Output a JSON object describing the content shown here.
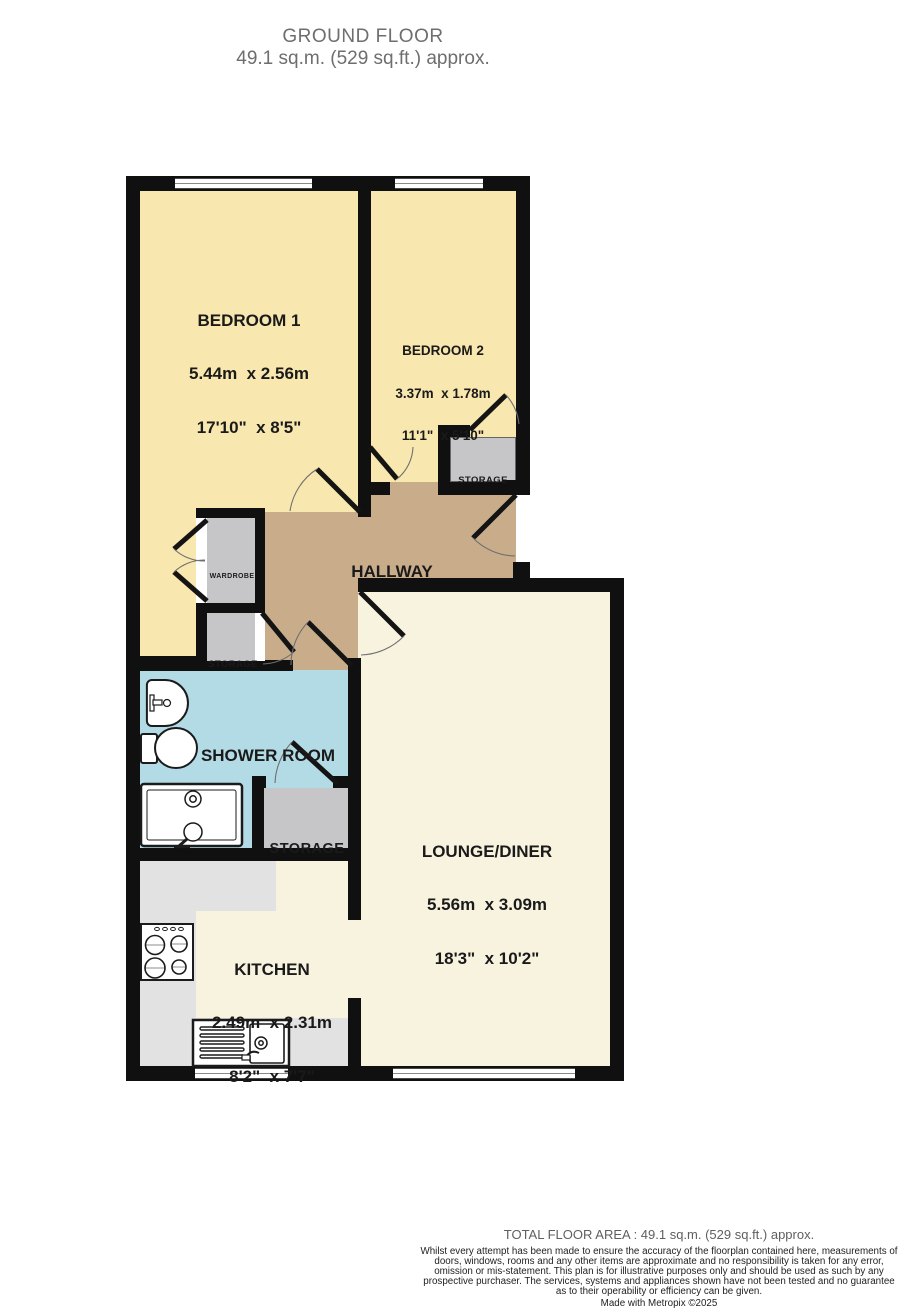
{
  "title": {
    "line1": "GROUND FLOOR",
    "line2": "49.1 sq.m. (529 sq.ft.) approx."
  },
  "rooms": {
    "bedroom1": {
      "name": "BEDROOM 1",
      "metric": "5.44m  x 2.56m",
      "imperial": "17'10\"  x 8'5\""
    },
    "bedroom2": {
      "name": "BEDROOM 2",
      "metric": "3.37m  x 1.78m",
      "imperial": "11'1\"  x 5'10\""
    },
    "hallway": {
      "name": "HALLWAY"
    },
    "shower_room": {
      "name": "SHOWER ROOM"
    },
    "lounge_diner": {
      "name": "LOUNGE/DINER",
      "metric": "5.56m  x 3.09m",
      "imperial": "18'3\"  x 10'2\""
    },
    "kitchen": {
      "name": "KITCHEN",
      "metric": "2.49m  x 2.31m",
      "imperial": "8'2\"  x 7'7\""
    },
    "storage_bedroom2": {
      "name": "STORAGE"
    },
    "storage_hall": {
      "name": "STORAGE"
    },
    "storage_shower": {
      "name": "STORAGE"
    },
    "wardrobe": {
      "name": "WARDROBE"
    }
  },
  "footer": {
    "total_area": "TOTAL FLOOR AREA : 49.1 sq.m. (529 sq.ft.) approx.",
    "disclaimer": "Whilst every attempt has been made to ensure the accuracy of the floorplan contained here, measurements of doors, windows, rooms and any other items are approximate and no responsibility is taken for any error, omission or mis-statement. This plan is for illustrative purposes only and should be used as such by any prospective purchaser. The services, systems and appliances shown have not been tested and no guarantee as to their operability or efficiency can be given.",
    "credit": "Made with Metropix ©2025"
  },
  "colors": {
    "bedroom": "#F8E7AE",
    "hallway": "#C9AD8B",
    "cream": "#F8F3DF",
    "shower": "#B3DBE6",
    "storage": "#C6C6C8",
    "counter": "#E2E2E2",
    "wall": "#101010"
  }
}
